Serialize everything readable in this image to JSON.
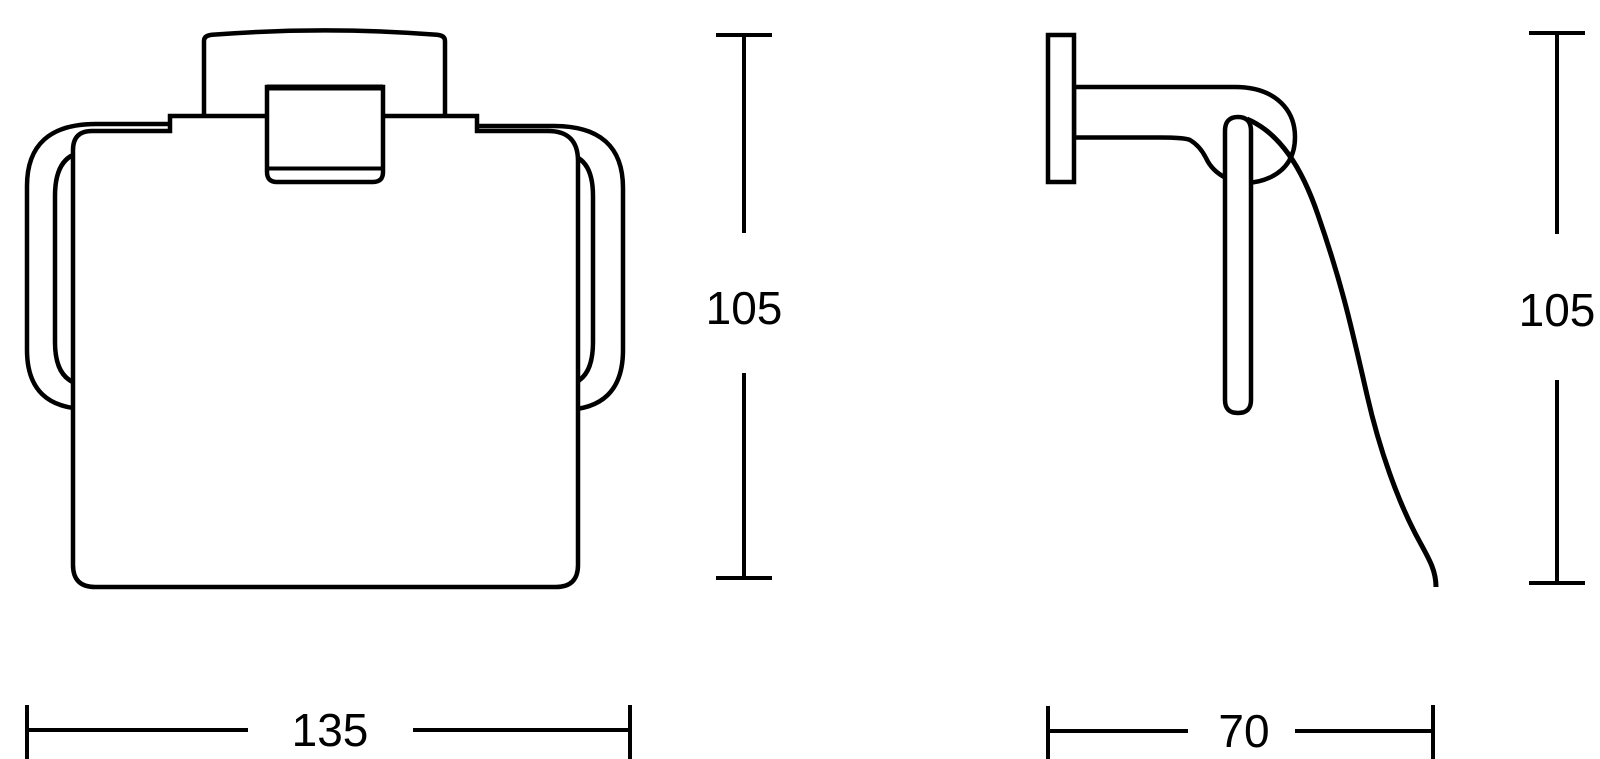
{
  "page": {
    "background_color": "#ffffff",
    "line_color": "#000000"
  },
  "dimensions": {
    "front_height": {
      "value": "105",
      "orientation": "vertical"
    },
    "front_width": {
      "value": "135",
      "orientation": "horizontal"
    },
    "side_height": {
      "value": "105",
      "orientation": "vertical"
    },
    "side_depth": {
      "value": "70",
      "orientation": "horizontal"
    }
  }
}
